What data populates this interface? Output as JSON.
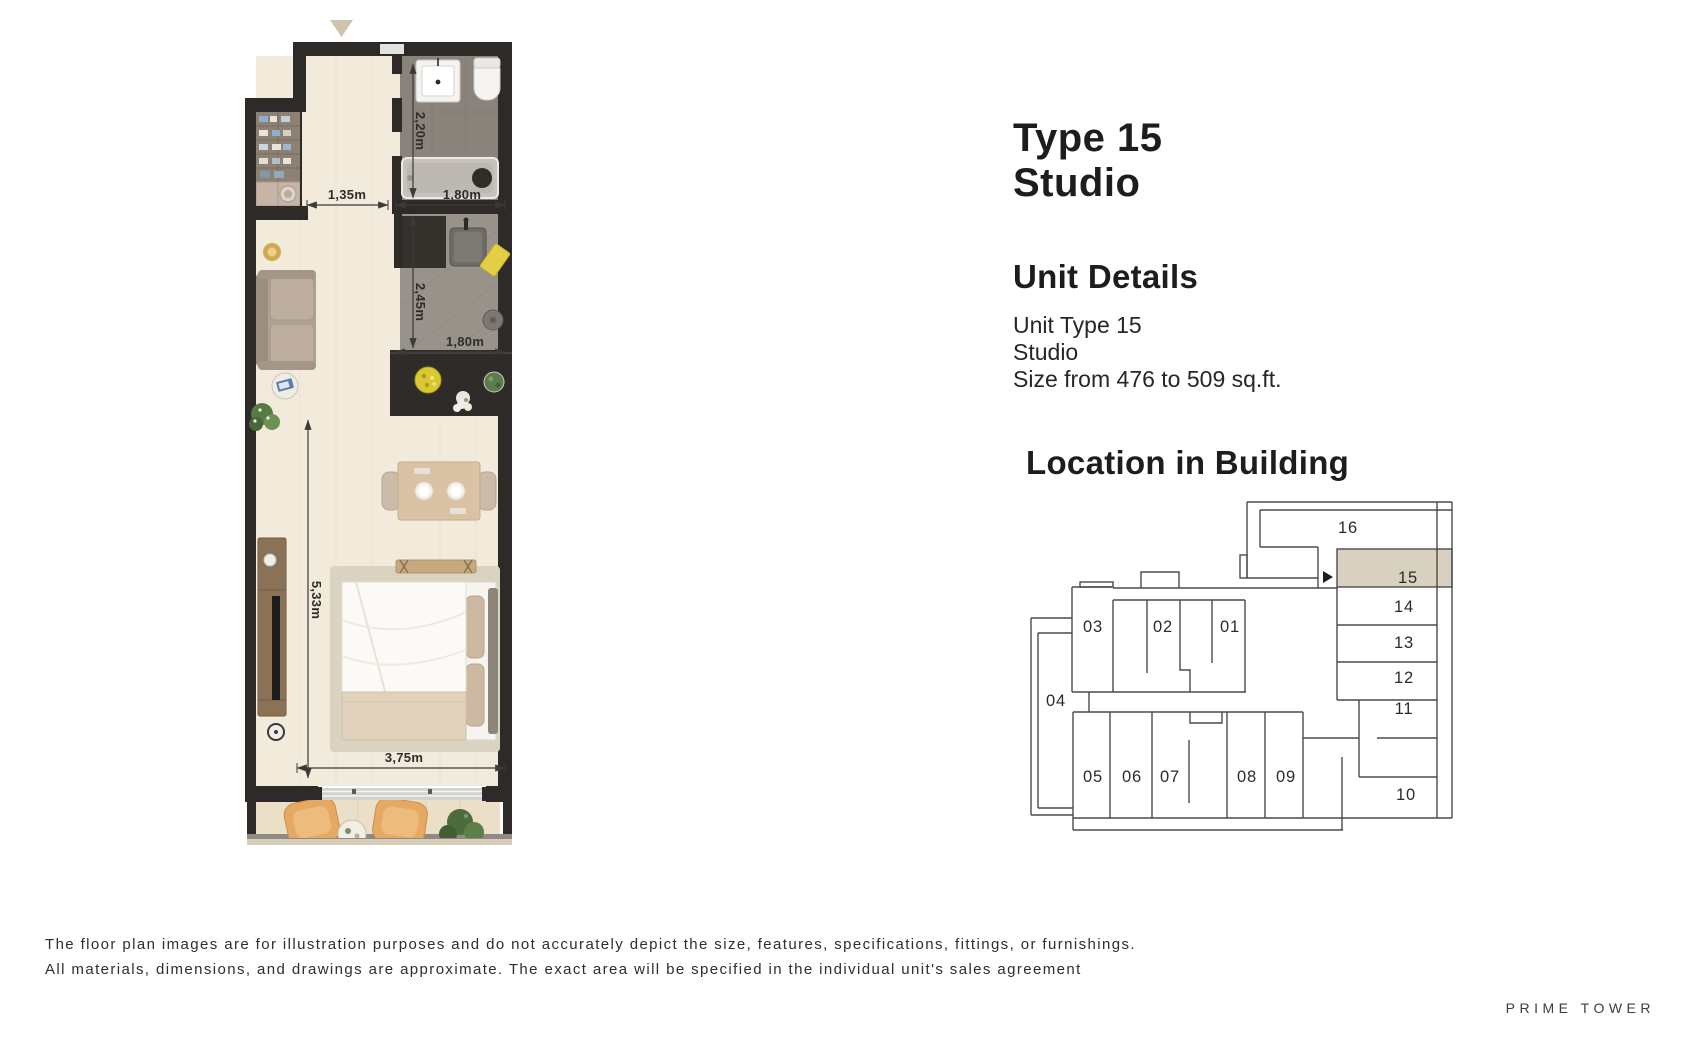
{
  "header": {
    "title_line1": "Type  15",
    "title_line2": "Studio"
  },
  "unit_details": {
    "heading": "Unit Details",
    "lines": [
      "Unit Type 15",
      "Studio",
      "Size  from 476 to 509 sq.ft."
    ]
  },
  "location": {
    "heading": "Location in Building",
    "highlighted_unit": "15",
    "highlight_color": "#d9d1c0",
    "units": {
      "u01": "01",
      "u02": "02",
      "u03": "03",
      "u04": "04",
      "u05": "05",
      "u06": "06",
      "u07": "07",
      "u08": "08",
      "u09": "09",
      "u10": "10",
      "u11": "11",
      "u12": "12",
      "u13": "13",
      "u14": "14",
      "u15": "15",
      "u16": "16"
    }
  },
  "floorplan": {
    "dimensions": {
      "entry_width": "1,35m",
      "bath_width": "1,80m",
      "bath_depth": "2,20m",
      "kitchen_depth": "2,45m",
      "kitchen_width": "1,80m",
      "living_length": "5,33m",
      "living_width": "3,75m"
    },
    "colors": {
      "wall": "#2d2a27",
      "floor": "#f2ebdc",
      "bath_floor": "#8a837b",
      "kitchen_floor": "#99928a",
      "counter": "#2e2b28",
      "balcony_floor": "#ebdfc8",
      "chair_tan": "#e5a963",
      "entry_marker": "#cfc3ac"
    }
  },
  "disclaimer": {
    "line1": "The floor plan images are for illustration purposes and do not accurately depict the size, features, specifications, fittings, or furnishings.",
    "line2": "All materials, dimensions, and drawings are approximate. The exact area will be specified in the individual unit's sales agreement"
  },
  "footer": {
    "brand": "PRIME TOWER"
  }
}
